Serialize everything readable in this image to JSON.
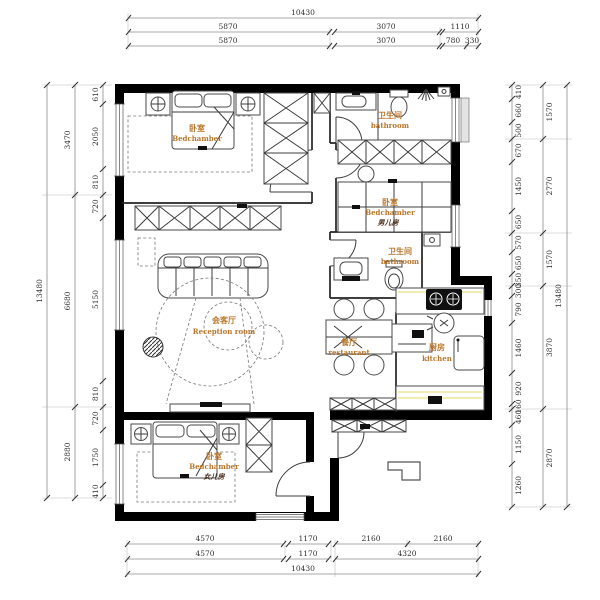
{
  "plan": {
    "rooms": {
      "bedroom_master": {
        "zh": "卧室",
        "en": "Bedchamber"
      },
      "bathroom_top": {
        "zh": "卫生间",
        "en": "bathroom"
      },
      "bedroom_boy": {
        "zh": "卧室",
        "en": "Bedchamber",
        "sub": "男儿房"
      },
      "bathroom_mid": {
        "zh": "卫生间",
        "en": "bathroom"
      },
      "reception": {
        "zh": "会客厅",
        "en": "Reception room"
      },
      "dining": {
        "zh": "餐厅",
        "en": "restaurant"
      },
      "kitchen": {
        "zh": "厨房",
        "en": "kitchen"
      },
      "bedroom_girl": {
        "zh": "卧室",
        "en": "Bedchamber",
        "sub": "女儿房"
      }
    }
  },
  "dims": {
    "top": {
      "row1": [
        "10430"
      ],
      "row2": [
        "5870",
        "3070",
        "1110"
      ],
      "row3": [
        "5870",
        "3070",
        "780",
        "330"
      ]
    },
    "bottom": {
      "row1": [
        "4570",
        "1170",
        "2160",
        "2160"
      ],
      "row2": [
        "4570",
        "1170",
        "4320"
      ],
      "row3": [
        "10430"
      ]
    },
    "left": {
      "outer": [
        "13480"
      ],
      "mid": [
        "3470",
        "6680",
        "2880"
      ],
      "inner": [
        "610",
        "2050",
        "810",
        "720",
        "5150",
        "810",
        "720",
        "1750",
        "410"
      ]
    },
    "right": {
      "outer": [
        "13480"
      ],
      "mid": [
        "1570",
        "2770",
        "1570",
        "3870",
        "2870"
      ],
      "inner": [
        "410",
        "660",
        "500",
        "670",
        "1450",
        "650",
        "570",
        "650",
        "350",
        "300",
        "790",
        "1460",
        "920",
        "160",
        "460",
        "1150",
        "1260"
      ]
    }
  },
  "colors": {
    "wall": "#000000",
    "line": "#3c3c3c",
    "dim_line": "#8c8c8c",
    "dim_text": "#2e2e2e",
    "room_label": "#b9772b",
    "sub_label": "#4a2c18",
    "counter_accent": "#e9e083",
    "background": "#ffffff"
  }
}
